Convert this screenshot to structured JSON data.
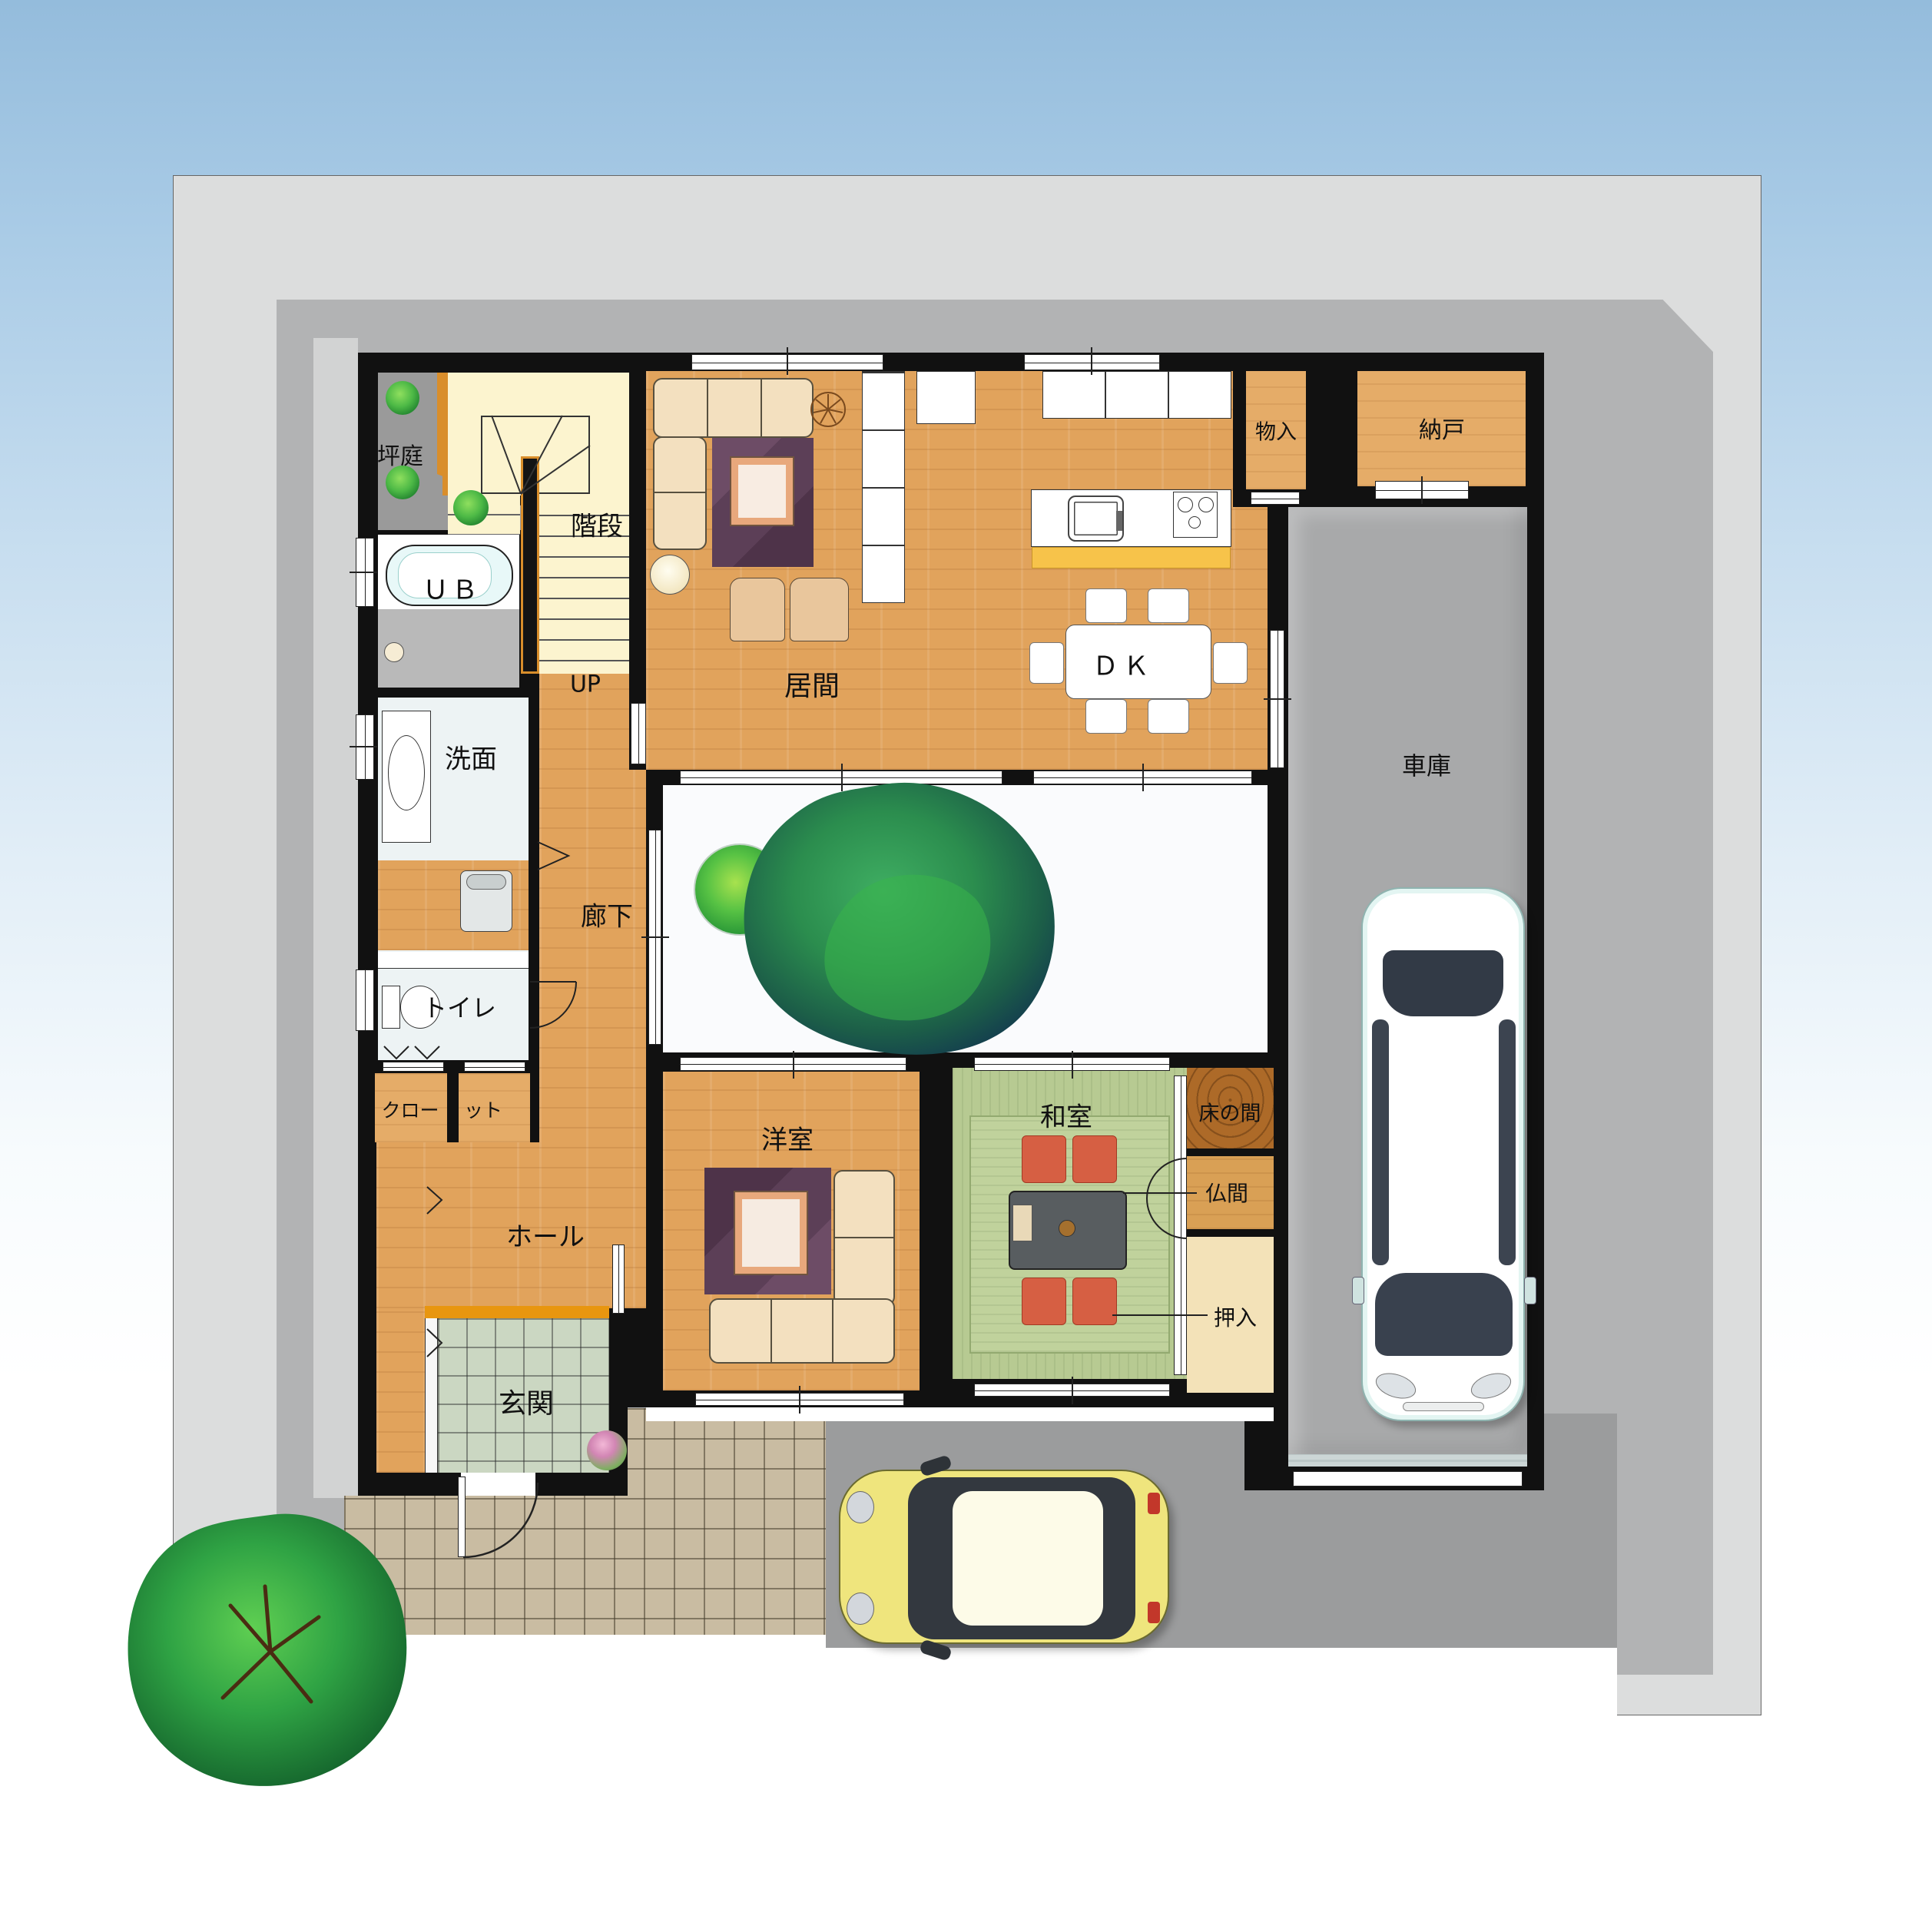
{
  "plan": {
    "type": "japanese-house-first-floor-plan",
    "rooms": {
      "tsuboniwa": {
        "label": "坪庭"
      },
      "kaidan": {
        "label": "階段"
      },
      "up": {
        "label": "UP"
      },
      "ub": {
        "label": "ＵＢ"
      },
      "senmen": {
        "label": "洗面"
      },
      "toilet": {
        "label": "トイレ"
      },
      "closet_l": {
        "label": "クロー"
      },
      "closet_r": {
        "label": "ット"
      },
      "hall": {
        "label": "ホール"
      },
      "genkan": {
        "label": "玄関"
      },
      "rouka": {
        "label": "廊下"
      },
      "ima": {
        "label": "居間"
      },
      "dk": {
        "label": "ＤＫ"
      },
      "monoire": {
        "label": "物入"
      },
      "nando": {
        "label": "納戸"
      },
      "shako": {
        "label": "車庫"
      },
      "youshitsu": {
        "label": "洋室"
      },
      "washitsu": {
        "label": "和室"
      },
      "tokonoma": {
        "label": "床の間"
      },
      "butsuma": {
        "label": "仏間"
      },
      "oshiire": {
        "label": "押入"
      }
    },
    "colors": {
      "wall": "#111111",
      "wood_floor": "#e1a35c",
      "tatami": "#b7ca92",
      "stairs": "#fcf4cf",
      "genkan_tile": "#cbd7c2",
      "approach_tile": "#c9bca2",
      "driveway": "#9b9c9d",
      "garage_floor": "#a8a9aa",
      "lot": "#dcdddd",
      "site_base": "#b2b3b4",
      "counter_accent": "#f7c34a",
      "threshold_accent": "#e8960f",
      "rug_purple": "#5c3f57",
      "sofa_cream": "#f3e0bf",
      "cushion_red": "#d65f43",
      "car_yellow": "#efe57d",
      "car_white": "#ffffff"
    }
  }
}
